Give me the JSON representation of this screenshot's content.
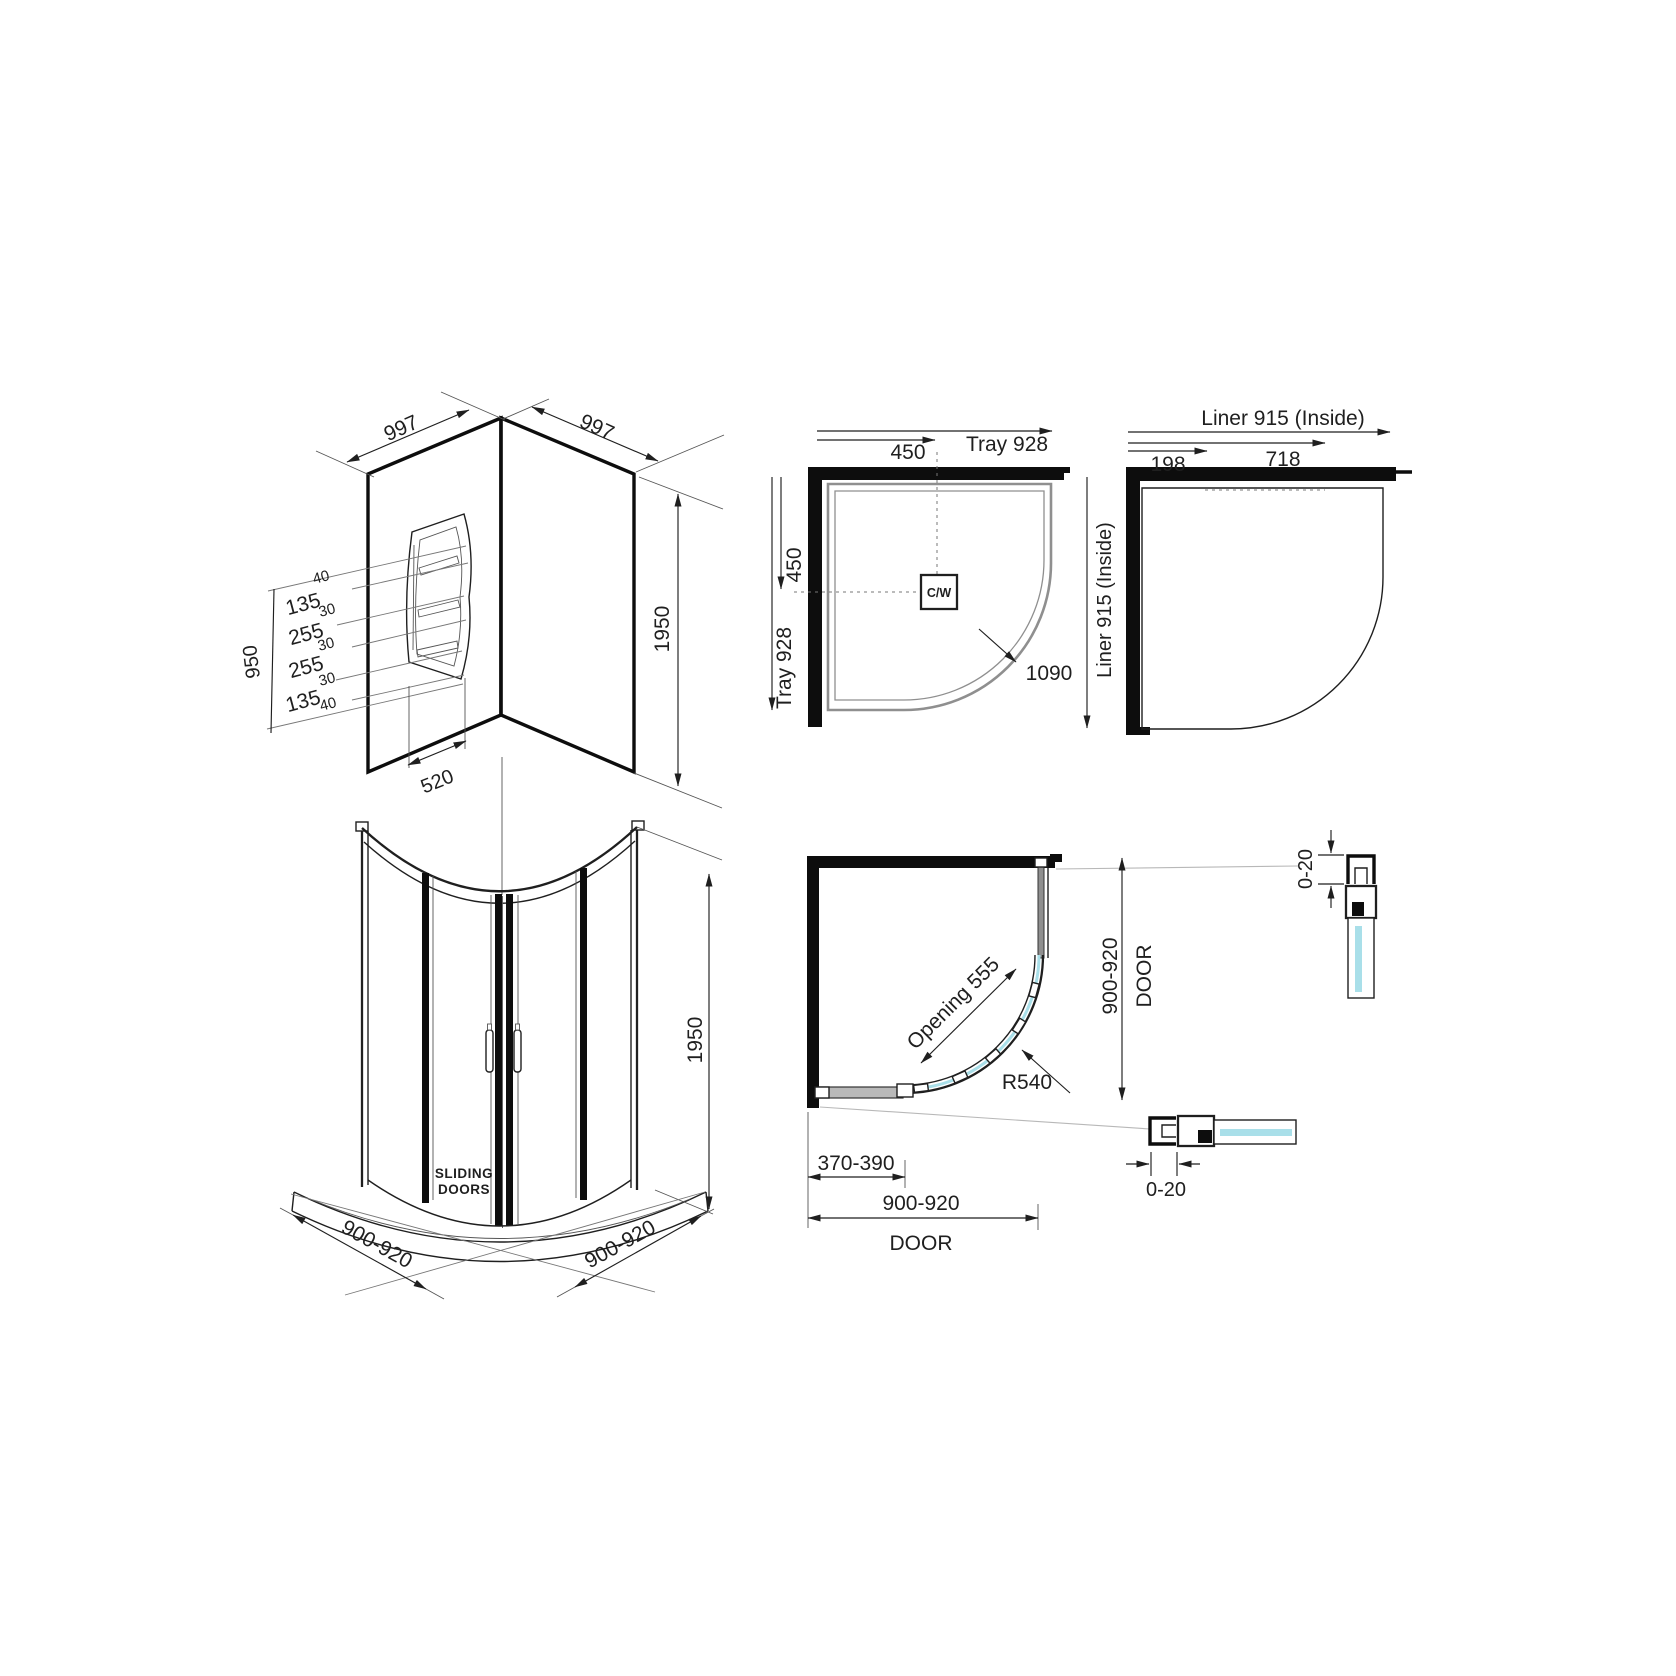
{
  "colors": {
    "line": "#1f1f1f",
    "wall": "#0d0d0d",
    "tray_gray": "#8f8f8f",
    "leader_gray": "#b8b8b8",
    "glass": "#a9dfe9",
    "background": "#ffffff"
  },
  "corner_walls": {
    "width_left": "997",
    "width_right": "997",
    "height": "1950",
    "shelf_stack_height": "950",
    "shelf_width": "520",
    "shelf_dims": [
      "40",
      "135",
      "30",
      "255",
      "30",
      "255",
      "30",
      "135",
      "40"
    ]
  },
  "tray_plan": {
    "offset_x": "450",
    "width": "Tray 928",
    "offset_y": "450",
    "height": "Tray 928",
    "waste": "C/W",
    "diagonal": "1090"
  },
  "liner_plan": {
    "width": "Liner 915 (Inside)",
    "height": "Liner 915 (Inside)",
    "segment_small": "198",
    "segment_large": "718"
  },
  "front_view": {
    "height": "1950",
    "width_left": "900-920",
    "width_right": "900-920",
    "doors_line1": "SLIDING",
    "doors_line2": "DOORS"
  },
  "door_plan": {
    "opening": "Opening 555",
    "radius": "R540",
    "side_width": "900-920",
    "side_label": "DOOR",
    "bottom_width": "900-920",
    "bottom_label": "DOOR",
    "panel_width": "370-390",
    "adjust_vertical": "0-20",
    "adjust_horizontal": "0-20"
  }
}
